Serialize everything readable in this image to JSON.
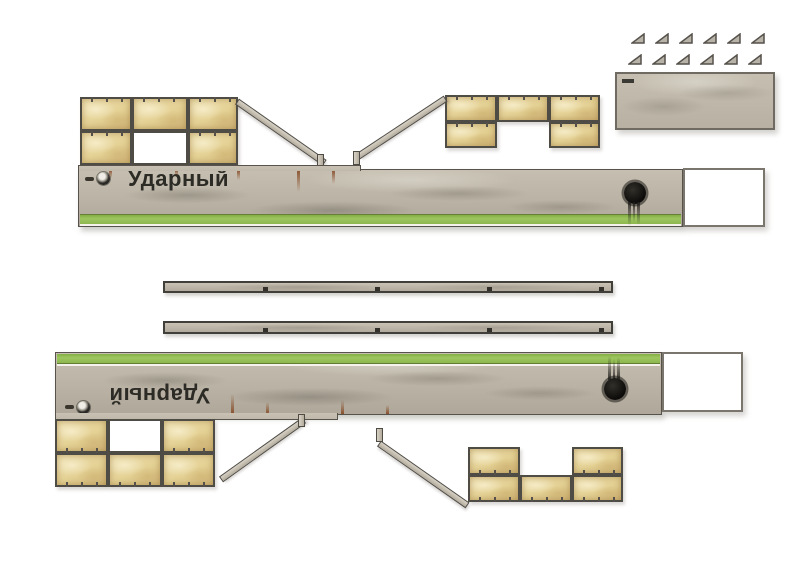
{
  "model": {
    "vessel_name": "Ударный"
  },
  "parts": {
    "hull_side_count": 2,
    "glue_triangle_count": 12,
    "runner_strip_count": 2,
    "sandbag_wall_section_count": 4,
    "ramp_strip_count": 4,
    "deck_plate_count": 1,
    "glue_tab_count": 2
  },
  "colors": {
    "background": "#ffffff",
    "hull_gray": "#b9b2a4",
    "waterline_green": "#93bd52",
    "sandbag_tan": "#e4d194",
    "frame_dark": "#4f4c46",
    "rust_brown": "#82411a",
    "hawse_black": "#0c0b0a",
    "ink_text": "#2d2b26"
  }
}
